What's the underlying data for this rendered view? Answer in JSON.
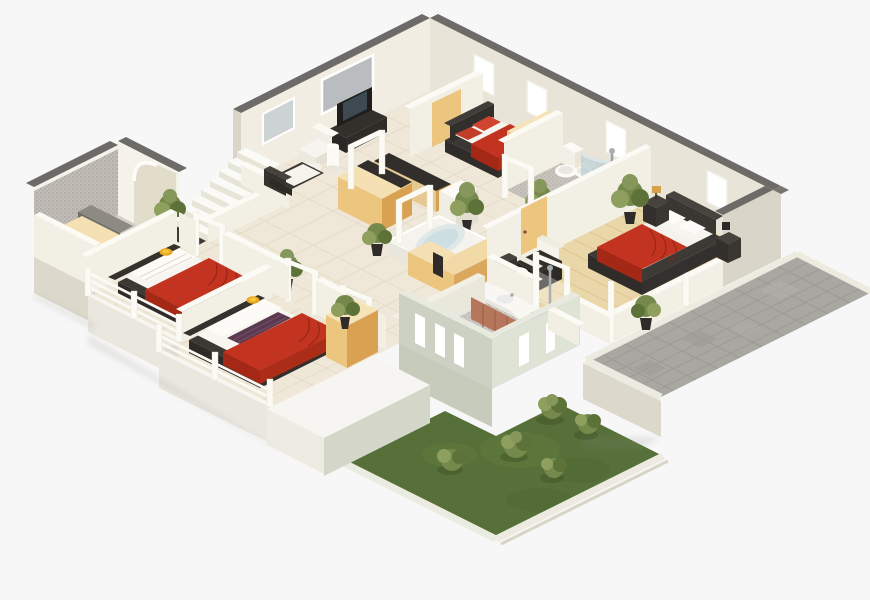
{
  "scene": {
    "type": "isometric-3d-floor-plan-render",
    "view": "axonometric-top-down",
    "background": "#f7f7f7",
    "floors_shown": 1
  },
  "palette": {
    "background": "#f7f7f7",
    "wallCap": "#6c6b67",
    "wallRight": "#e9e4d8",
    "wallLeft": "#f1ede3",
    "wallEnd": "#d9d5c8",
    "whiteWall": "#f2efe5",
    "whiteTop": "#fbfaf5",
    "tile": "#efe8d9",
    "tileLine": "#e0d7c1",
    "wood": "#ead7a9",
    "woodLine": "#d9c18c",
    "mosaic": "#b2afa9",
    "mosaicFloor": "#ded9d1",
    "bathMosaic": "#c9c5be",
    "red": "#c23420",
    "redDark": "#a52817",
    "redFold": "#8f2212",
    "dark": "#3b3733",
    "darker": "#2e2b28",
    "mattress": "#f7f5ef",
    "pillow": "#fcfbf7",
    "purple": "#5b3a50",
    "yellow": "#e8a71e",
    "yellowLight": "#f6c53e",
    "tanTop": "#f4e0b2",
    "tan": "#ecc57f",
    "tanSide": "#d9a253",
    "counter": "#312e2b",
    "glass": "#a9c4cd",
    "window": "#b9bdbf",
    "chrome": "#a7adaf",
    "terracotta": "#b5765c",
    "terracottaSide": "#9c614a",
    "paver": "#a8a7a1",
    "paverLine": "#92918b",
    "curb": "#ecebdf",
    "grass": "#57703a",
    "grassLight": "#69823f",
    "bush": "#76894c",
    "bushDark": "#5d7239",
    "bushLight": "#8fa05e",
    "pot": "#2e2b28",
    "base": "#dcd9cc",
    "baseLight": "#eae8de",
    "greenWall": "#ccd1c3",
    "greenWallSide": "#dfe3d6",
    "white": "#fbfaf6"
  },
  "rooms": [
    {
      "id": "entry-bathroom",
      "features": [
        "gray-mosaic-accent-wall",
        "arched-doorway",
        "wood-vanity",
        "counter"
      ]
    },
    {
      "id": "living-room",
      "features": [
        "tv",
        "tv-cabinet",
        "white-armchair",
        "dark-sofa",
        "floor-lamp",
        "side-table",
        "picture-window"
      ]
    },
    {
      "id": "staircase",
      "features": [
        "floating-white-steps",
        "dark-landing-mat",
        "low-white-wall"
      ]
    },
    {
      "id": "kitchen",
      "features": [
        "wood-island",
        "dark-countertop",
        "bar-counter",
        "white-appliance"
      ]
    },
    {
      "id": "guest-bedroom",
      "features": [
        "red-duvet-bed",
        "dark-headboard",
        "red-pillows",
        "tan-wardrobe",
        "partition-panel"
      ]
    },
    {
      "id": "central-bathroom",
      "features": [
        "toilet",
        "bidet",
        "curved-glass-shower",
        "bathtub-terracotta-apron",
        "mosaic-floor",
        "plant"
      ]
    },
    {
      "id": "spa-bathroom",
      "features": [
        "jacuzzi",
        "tan-l-vanity",
        "dark-stool",
        "plant"
      ]
    },
    {
      "id": "bedroom-1",
      "features": [
        "red-duvet-bed",
        "white-pillows",
        "yellow-round-cushion",
        "dark-platform",
        "white-railing",
        "white-bench"
      ]
    },
    {
      "id": "bedroom-2",
      "features": [
        "red-duvet-bed",
        "purple-pillows",
        "yellow-round-cushion",
        "dark-platform",
        "tan-wardrobe",
        "white-railing",
        "plant"
      ]
    },
    {
      "id": "master-bedroom",
      "features": [
        "wood-floor",
        "red-duvet-bed",
        "dark-headboard",
        "nightstands",
        "lamps",
        "plants",
        "dark-armchair",
        "white-drum-ottoman",
        "tan-door",
        "balcony-pillars"
      ]
    },
    {
      "id": "lower-bathroom",
      "features": [
        "curved-vanity-terracotta",
        "sink",
        "shower-column",
        "mosaic-floor",
        "slit-windows",
        "green-tinted-walls"
      ]
    },
    {
      "id": "terrace",
      "features": [
        "gray-stone-pavers",
        "white-curb"
      ]
    },
    {
      "id": "garden",
      "features": [
        "lawn",
        "five-bushes",
        "white-curb"
      ]
    },
    {
      "id": "patio",
      "features": [
        "white-slab"
      ]
    }
  ]
}
